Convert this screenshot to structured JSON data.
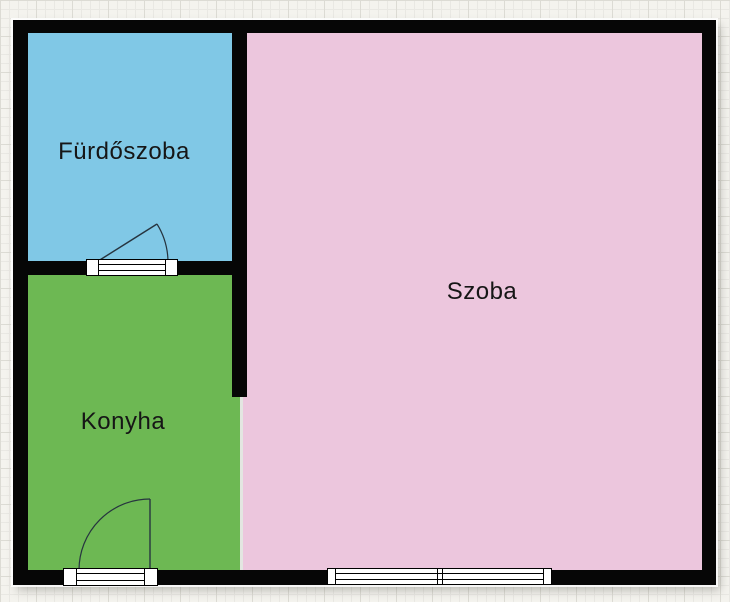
{
  "plan": {
    "wall_color": "#060606",
    "paper": {
      "background": "#f4f3ee",
      "grid_minor": "#e9e8e3",
      "grid_major": "#dcdbd4"
    },
    "rooms": [
      {
        "id": "bathroom",
        "label": "Fürdőszoba",
        "color": "#80c8e6"
      },
      {
        "id": "living-room",
        "label": "Szoba",
        "color": "#ecc6dd"
      },
      {
        "id": "kitchen",
        "label": "Konyha",
        "color": "#6db853"
      }
    ],
    "openings": {
      "sill_color": "#ffffff",
      "frame_color": "#000000",
      "swing_stroke": "#26343f",
      "items": [
        {
          "id": "bathroom-door",
          "type": "door"
        },
        {
          "id": "kitchen-door",
          "type": "door"
        },
        {
          "id": "main-window",
          "type": "window"
        }
      ]
    },
    "label_color": "#161616"
  }
}
